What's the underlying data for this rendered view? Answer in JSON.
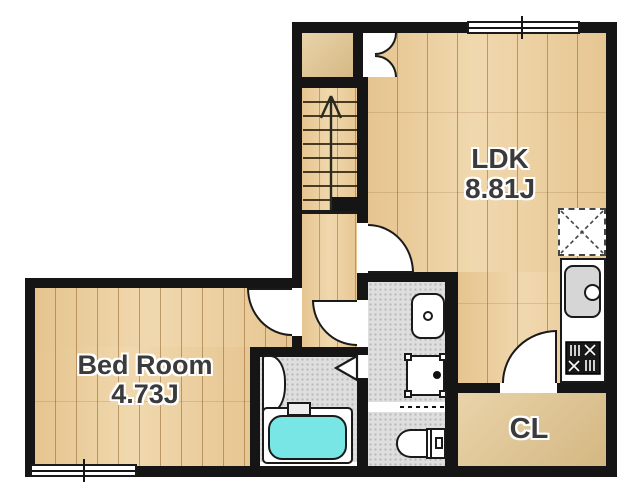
{
  "plan": {
    "type": "apartment-floor-plan",
    "rooms": {
      "ldk": {
        "name": "LDK",
        "size": "8.81J"
      },
      "bedroom": {
        "name": "Bed Room",
        "size": "4.73J"
      },
      "closet": {
        "name": "CL"
      }
    },
    "fixtures": [
      "staircase-up-arrow",
      "entry-double-door",
      "sliding-window-top",
      "sliding-window-bedroom",
      "refrigerator-space",
      "kitchen-counter",
      "kitchen-sink",
      "gas-stove",
      "wash-basin",
      "washing-machine-pan",
      "accordion-door",
      "toilet",
      "bath-vanity",
      "bifold-bath-door",
      "bathtub",
      "hinged-doors"
    ],
    "colors": {
      "wall": "#151515",
      "wood_floor": "#ecd1a3",
      "plain_floor": "#ddc28f",
      "wet_area_floor": "#dedede",
      "bathtub": "#77e6e4",
      "fixture_white": "#ffffff"
    }
  }
}
